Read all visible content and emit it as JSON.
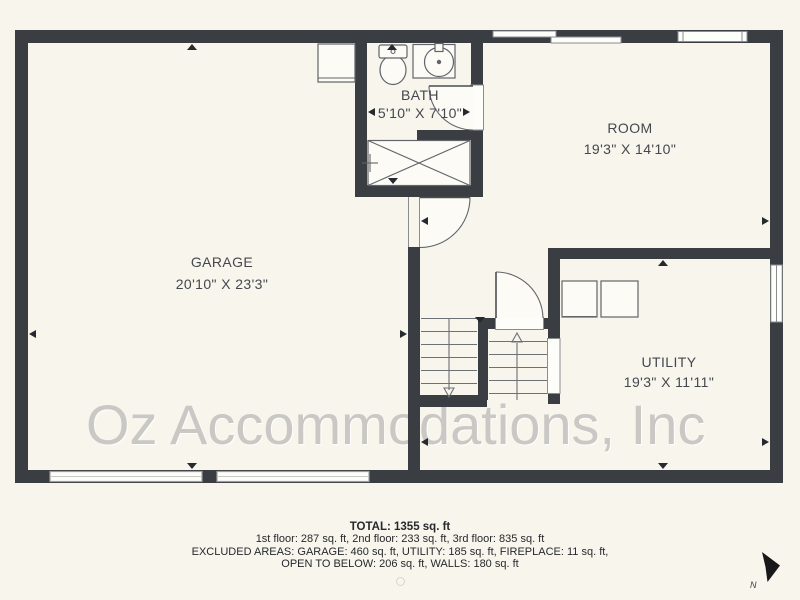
{
  "watermark": "Oz Accommodations, Inc",
  "rooms": [
    {
      "name": "GARAGE",
      "dimensions": "20'10\" X 23'3\""
    },
    {
      "name": "BATH",
      "dimensions": "5'10\" X 7'10\""
    },
    {
      "name": "ROOM",
      "dimensions": "19'3\" X 14'10\""
    },
    {
      "name": "UTILITY",
      "dimensions": "19'3\" X 11'11\""
    }
  ],
  "summary": {
    "total": "TOTAL: 1355 sq. ft",
    "floors": "1st floor: 287 sq. ft, 2nd floor: 233 sq. ft, 3rd floor: 835 sq. ft",
    "excluded_line1": "EXCLUDED AREAS: GARAGE: 460 sq. ft, UTILITY: 185 sq. ft, FIREPLACE: 11 sq. ft,",
    "excluded_line2": "OPEN TO BELOW: 206 sq. ft, WALLS: 180 sq. ft"
  },
  "compass": {
    "label": "N"
  },
  "icons": [
    "north-arrow-icon",
    "toilet-icon",
    "sink-icon",
    "shower-icon",
    "shower-valve-icon",
    "washer-icon",
    "dryer-icon",
    "stairs-up-arrow",
    "stairs-down-arrow"
  ],
  "colors": {
    "background": "#f7f5ec",
    "wall": "#3a3d42",
    "watermark": "#c9c8c4",
    "label_text": "#44484e",
    "footer_text": "#26292c"
  }
}
